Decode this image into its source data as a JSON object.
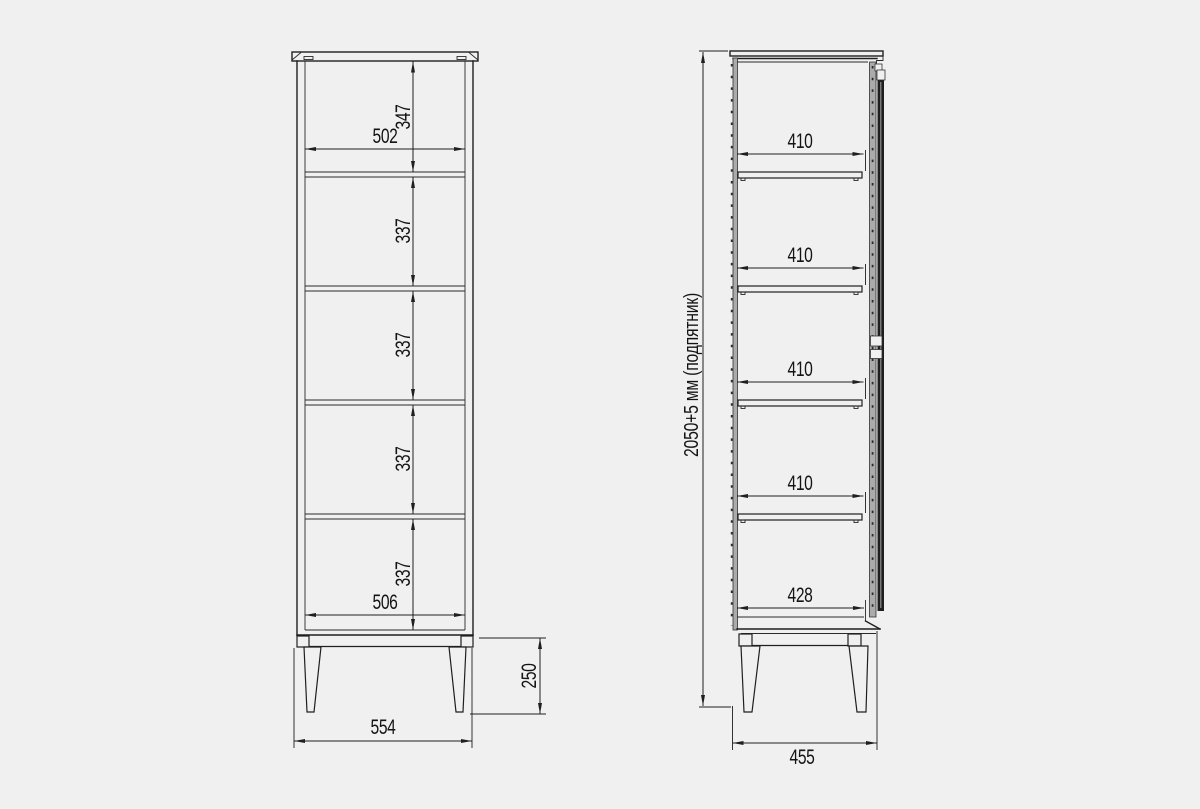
{
  "drawing": {
    "type": "furniture-dimension-drawing",
    "colors": {
      "background": "#f0f0f0",
      "line": "#1f1f1f",
      "panel_gray": "#ababab",
      "door_dark": "#1e1e1e"
    },
    "front_view": {
      "dimensions": {
        "inner_width_top": "502",
        "inner_width_bottom": "506",
        "overall_width": "554",
        "compartment_heights": [
          "347",
          "337",
          "337",
          "337",
          "337"
        ],
        "leg_height": "250"
      }
    },
    "side_view": {
      "dimensions": {
        "shelf_depths": [
          "410",
          "410",
          "410",
          "410"
        ],
        "bottom_depth": "428",
        "overall_depth": "455",
        "overall_height": "2050+5 мм (подпятник)"
      }
    }
  }
}
